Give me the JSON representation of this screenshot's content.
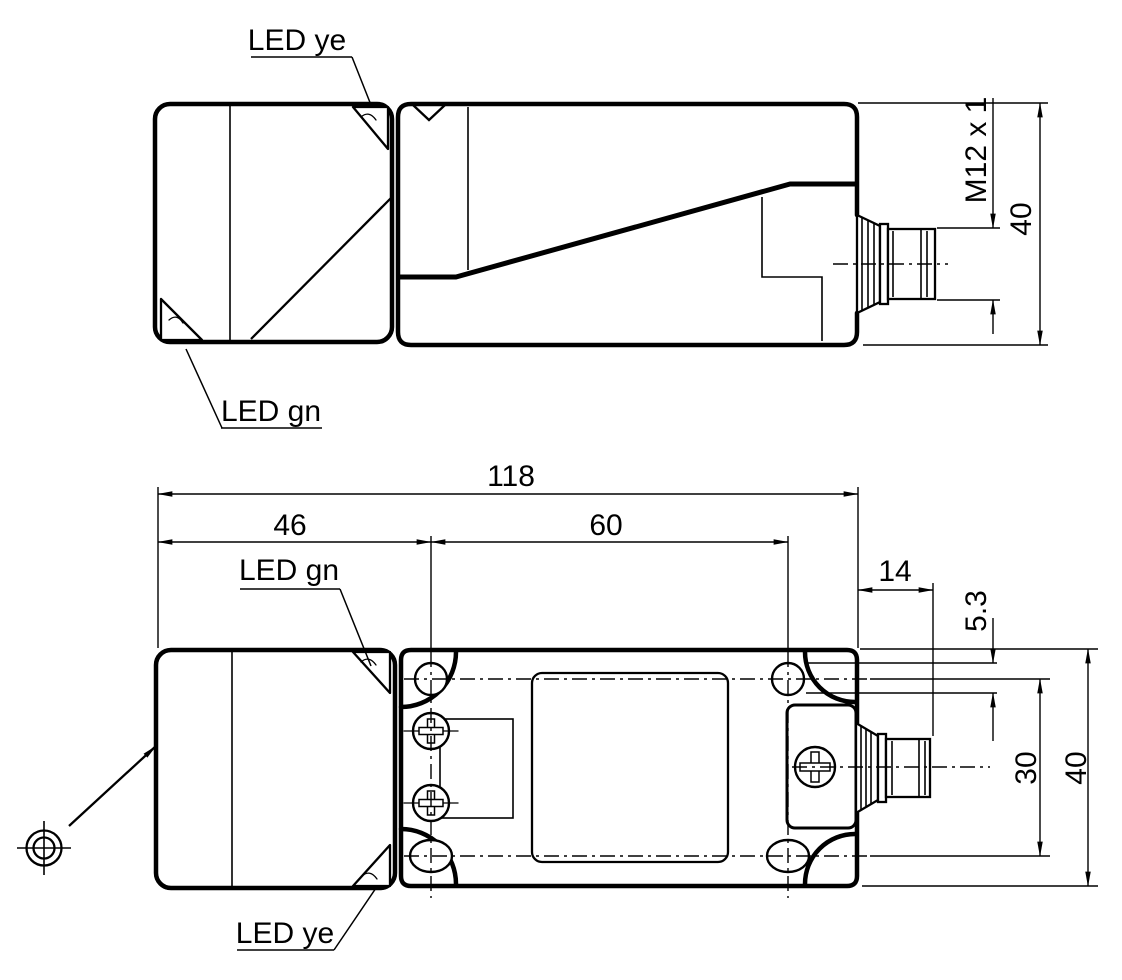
{
  "drawing_type": "sensor dimensional drawing",
  "side_view": {
    "led_top_label": "LED ye",
    "led_bottom_label": "LED gn",
    "dim_thread": "M12 x 1",
    "dim_height": "40"
  },
  "top_view": {
    "led_top_label": "LED gn",
    "led_bottom_label": "LED ye",
    "dim_overall_length": "118",
    "dim_head_length": "46",
    "dim_hole_spacing_long": "60",
    "dim_connector_length": "14",
    "dim_hole_width": "5.3",
    "dim_hole_spacing_cross": "30",
    "dim_body_width": "40"
  },
  "symbols": {
    "target": "reference-target-symbol",
    "sensing_direction": "sensing-face-arrow"
  },
  "colors": {
    "ink": "#000000",
    "paper": "#ffffff"
  }
}
